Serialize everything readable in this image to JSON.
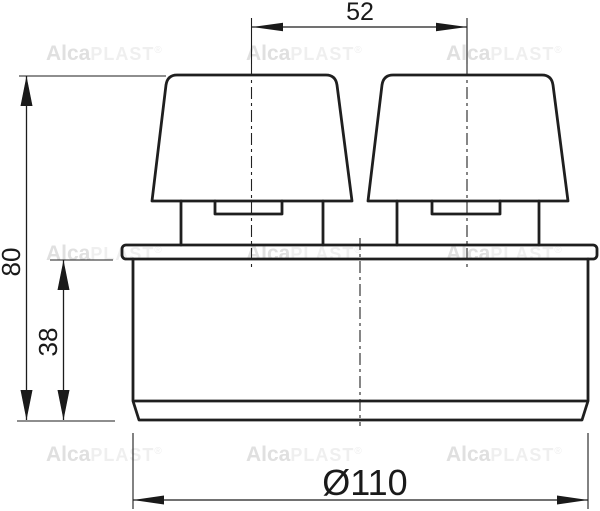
{
  "watermark": {
    "alca": "Alca",
    "plast": "PLAST",
    "reg": "®"
  },
  "dimensions": {
    "cap_spacing": "52",
    "overall_height": "80",
    "body_height": "38",
    "diameter": "Ø110"
  },
  "colors": {
    "object_line": "#1f1f1f",
    "dimension_line": "#1c1c1c",
    "watermark_dark": "#e0e0e0",
    "watermark_light": "#efefef",
    "background": "#ffffff"
  }
}
